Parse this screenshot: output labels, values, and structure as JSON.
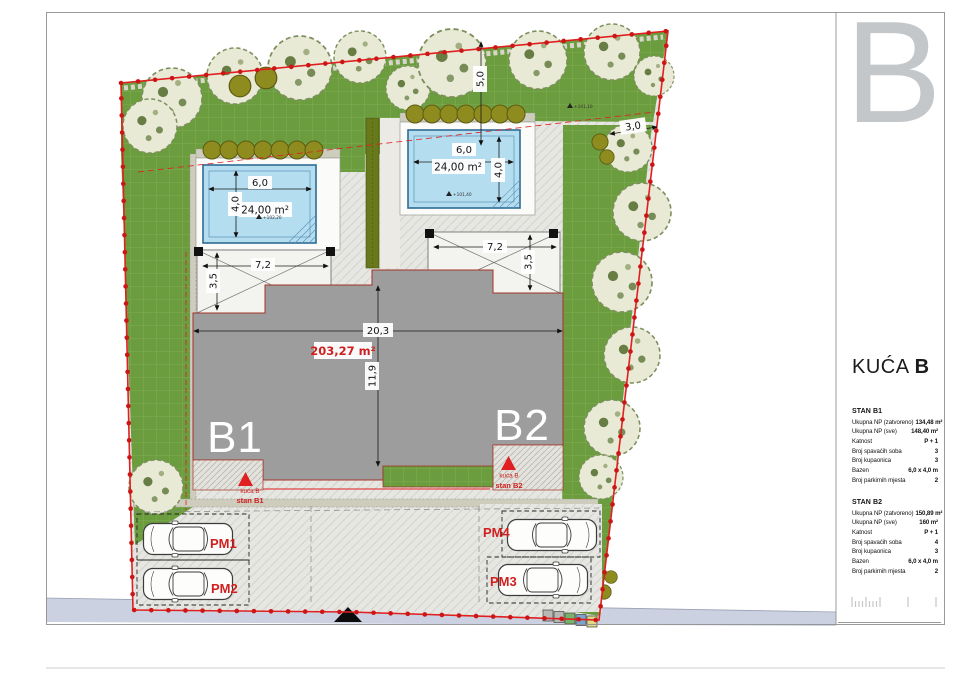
{
  "panel": {
    "corner_letter": "B",
    "title_main": "KUĆA",
    "title_accent": "B",
    "sections": [
      {
        "header": "STAN B1",
        "rows": [
          {
            "label": "Ukupna NP (zatvoreno)",
            "value": "134,48 m²"
          },
          {
            "label": "Ukupna NP (sve)",
            "value": "148,40 m²"
          },
          {
            "label": "Katnost",
            "value": "P + 1"
          },
          {
            "label": "Broj spavaćih soba",
            "value": "3"
          },
          {
            "label": "Broj kupaonica",
            "value": "3"
          },
          {
            "label": "Bazen",
            "value": "6,0 x 4,0 m"
          },
          {
            "label": "Broj parkirnih mjesta",
            "value": "2"
          }
        ]
      },
      {
        "header": "STAN B2",
        "rows": [
          {
            "label": "Ukupna NP (zatvoreno)",
            "value": "150,89 m²"
          },
          {
            "label": "Ukupna NP (sve)",
            "value": "160 m²"
          },
          {
            "label": "Katnost",
            "value": "P + 1"
          },
          {
            "label": "Broj spavaćih soba",
            "value": "4"
          },
          {
            "label": "Broj kupaonica",
            "value": "3"
          },
          {
            "label": "Bazen",
            "value": "6,0 x 4,0 m"
          },
          {
            "label": "Broj parkirnih mjesta",
            "value": "2"
          }
        ]
      }
    ]
  },
  "plan": {
    "units": {
      "b1": "B1",
      "b2": "B2"
    },
    "building": {
      "width": "20,3",
      "depth": "11,9",
      "area": "203,27 m²"
    },
    "pools": [
      {
        "width": "6,0",
        "depth": "4,0",
        "area": "24,00 m²",
        "elevation": "+102,20"
      },
      {
        "width": "6,0",
        "depth": "4,0",
        "area": "24,00 m²",
        "elevation": "+101,40"
      }
    ],
    "carports": [
      {
        "width": "7,2",
        "depth": "3,5"
      },
      {
        "width": "7,2",
        "depth": "3,5"
      }
    ],
    "site_dims": {
      "top_setback": "5,0",
      "right_setback": "3,0"
    },
    "top_elevation": "+101,10",
    "parking_labels": [
      "PM1",
      "PM2",
      "PM3",
      "PM4"
    ],
    "entrances": [
      {
        "house": "kuća B",
        "unit": "stan B1"
      },
      {
        "house": "kuća B",
        "unit": "stan B2"
      }
    ],
    "colors": {
      "boundary_red": "#e02020",
      "grass_green": "#6b9c3e",
      "pool_blue": "#b5ddf0",
      "building_gray": "#9d9d9d",
      "road_gray": "#cbd1e0",
      "label_red": "#cf1f1f"
    }
  }
}
